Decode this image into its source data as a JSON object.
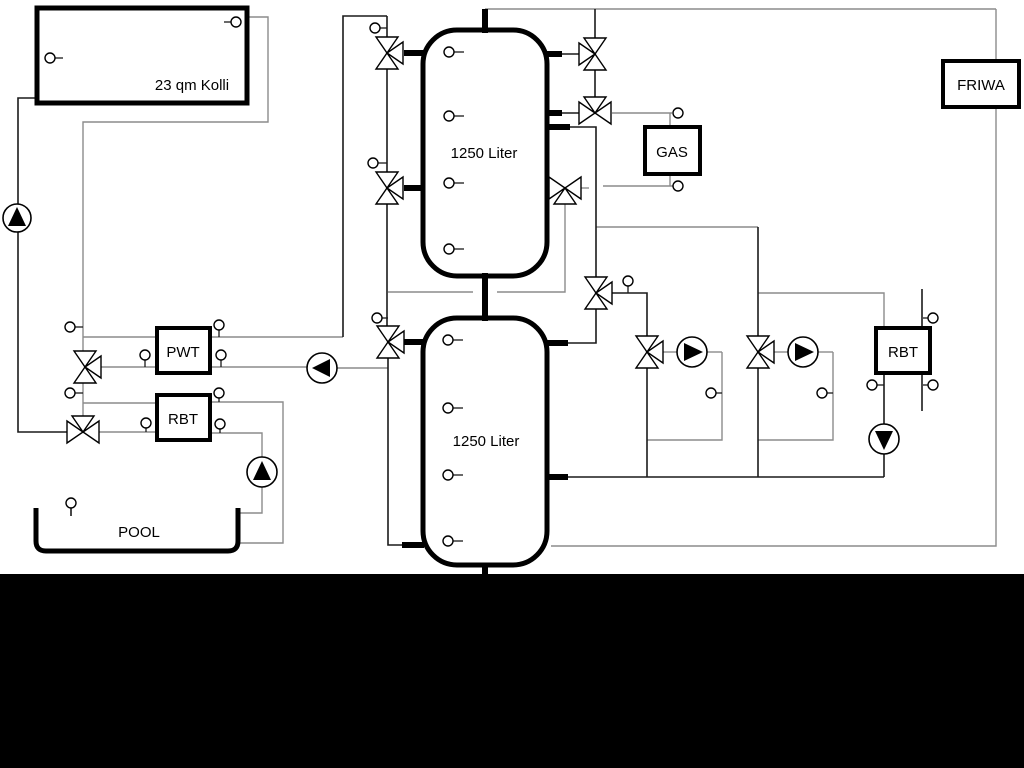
{
  "diagram": {
    "collector": {
      "label": "23 qm Kolli"
    },
    "tank_top": {
      "label": "1250 Liter"
    },
    "tank_bottom": {
      "label": "1250 Liter"
    },
    "gas_boiler": {
      "label": "GAS"
    },
    "friwa": {
      "label": "FRIWA"
    },
    "pwt": {
      "label": "PWT"
    },
    "rbt_pool": {
      "label": "RBT"
    },
    "rbt_right": {
      "label": "RBT"
    },
    "pool": {
      "label": "POOL"
    },
    "colors": {
      "line_dark": "#1a1a1a",
      "line_gray": "#8c8c8c",
      "background": "#ffffff",
      "bottom_band": "#000000"
    }
  }
}
